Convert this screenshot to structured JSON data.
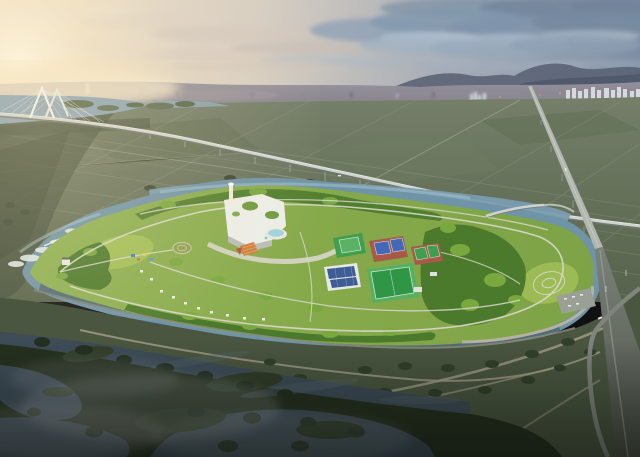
{
  "palette": {
    "sky_warm": "#f4e3c6",
    "sky_cool": "#7d8da3",
    "sun_glow": "#fdf4dc",
    "cloud_light": "#b9c6d2",
    "cloud_dark": "#72849b",
    "hills": "#5b6375",
    "city_haze": "#94909b",
    "apartment_white": "#d6d9de",
    "farmland": "#55614a",
    "farmland_dark": "#3c4836",
    "field_line": "#99a28b",
    "river": "#8ba3b4",
    "canal": "#6f93a7",
    "canal_light": "#9cbccb",
    "rapids": "#e9f1f3",
    "park_green": "#86a94a",
    "lawn": "#9cbb54",
    "tree_dark": "#4c7a2c",
    "tree_light": "#79a83f",
    "path": "#d9d8cc",
    "building_white": "#eceee8",
    "building_shadow": "#b9bdb8",
    "roof_garden": "#6f9a3f",
    "terrace_orange": "#cd7d3f",
    "pool_blue": "#9fd3dc",
    "court_green": "#3f9f4e",
    "court_blue": "#4468b8",
    "court_clay": "#a85948",
    "field_green": "#2f9646",
    "field_border": "#57b060",
    "solar_roof": "#3e5d96",
    "viaduct": "#cfd3cf",
    "viaduct_dark": "#4a5046",
    "bridge_white": "#f1f4f3",
    "embankment": "#4a5640",
    "embankment_path": "#a59f89",
    "wetland": "#26301f",
    "wetland_water": "#3e4c57",
    "wetland_tree": "#233020",
    "mist": "#c7ccd1",
    "road_dark": "#7f857c",
    "car_white": "#e8e9e6"
  },
  "scene": {
    "type": "aerial-architectural-rendering",
    "sky": {
      "label": "dusk sky with sunset glow on left and blue-grey clouds on right"
    },
    "background": {
      "label": "hazy city skyline, distant hills, white apartment towers"
    },
    "bridges": [
      {
        "name": "cable-stayed-bridge",
        "label": "white cable-stayed bridge over river"
      },
      {
        "name": "long-expressway-viaduct",
        "label": "elevated expressway crossing farmland"
      },
      {
        "name": "tall-expressway-viaduct",
        "label": "second elevated expressway descending to foreground"
      },
      {
        "name": "canal-bridge",
        "label": "small bridge over park canal"
      }
    ],
    "midground": {
      "label": "green farmland grid"
    },
    "park": {
      "label": "riverside island park surrounded by canal",
      "facilities": [
        {
          "name": "visitor-center-building",
          "label": "white cultural center with rooftop gardens"
        },
        {
          "name": "observation-tower",
          "label": "white tower"
        },
        {
          "name": "terraced-garden",
          "label": "orange terraced garden"
        },
        {
          "name": "swimming-pool",
          "label": "outdoor pool"
        },
        {
          "name": "multi-use-court",
          "label": "green multi-use court"
        },
        {
          "name": "tennis-courts",
          "label": "blue courts on clay apron"
        },
        {
          "name": "dual-courts",
          "label": "two green courts on clay apron"
        },
        {
          "name": "soccer-field",
          "label": "green soccer field"
        },
        {
          "name": "solar-roof-gym",
          "label": "building with solar panel roof"
        },
        {
          "name": "event-meadow",
          "label": "east meadow with looped paths"
        },
        {
          "name": "pavilion-tents",
          "label": "white pavilions"
        },
        {
          "name": "playground",
          "label": "colorful playground"
        },
        {
          "name": "parking-lot",
          "label": "parking lot with cars"
        }
      ]
    },
    "foreground": {
      "label": "dark wetland with winding channels, tree rows, embankment paths and mist"
    }
  }
}
